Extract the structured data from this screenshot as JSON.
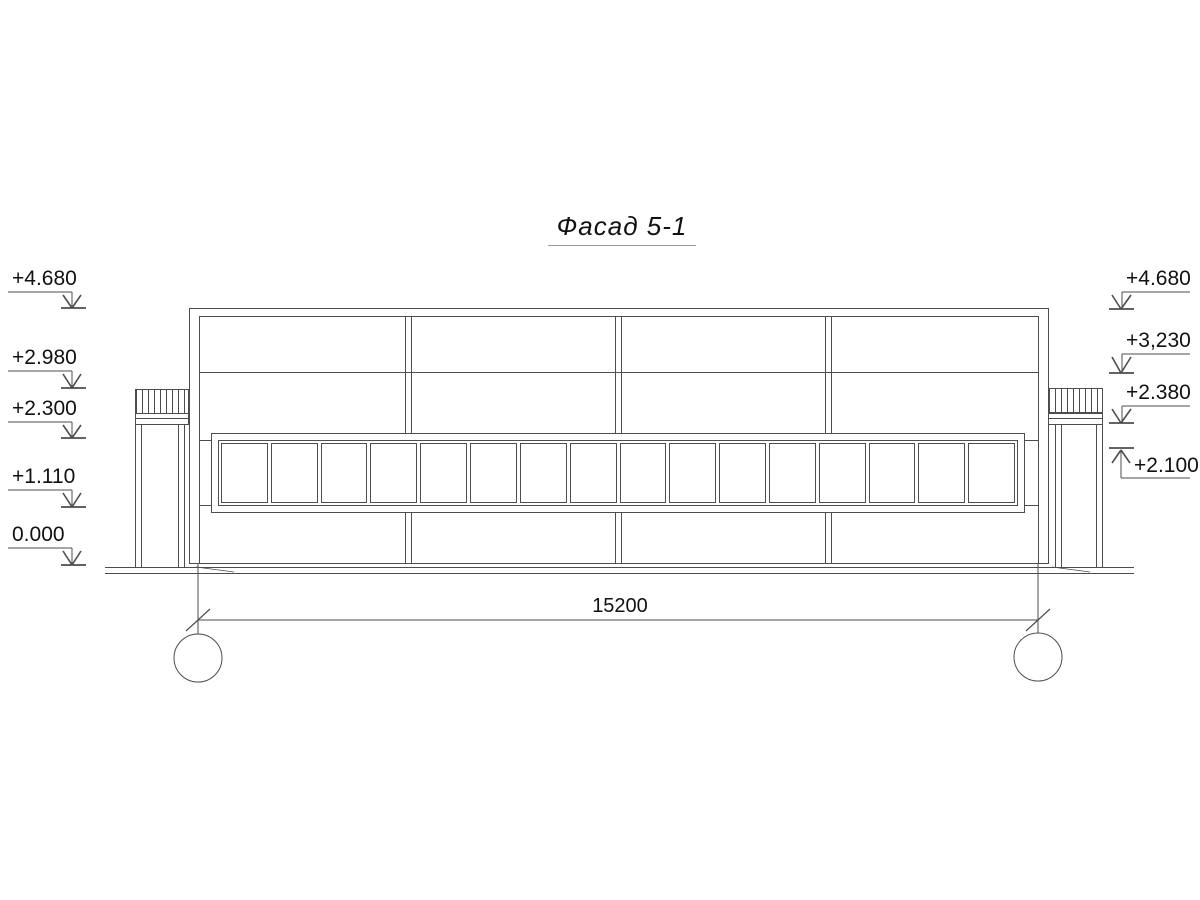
{
  "title": "Фасад 5-1",
  "elevation_marks": {
    "left": [
      {
        "label": "+4.680",
        "leader_y": 292,
        "bar_y": 308
      },
      {
        "label": "+2.980",
        "leader_y": 371,
        "bar_y": 388
      },
      {
        "label": "+2.300",
        "leader_y": 422,
        "bar_y": 438
      },
      {
        "label": "+1.110",
        "leader_y": 490,
        "bar_y": 507
      },
      {
        "label": "0.000",
        "leader_y": 548,
        "bar_y": 565
      }
    ],
    "right": [
      {
        "label": "+4.680",
        "leader_y": 292,
        "bar_y": 309,
        "direction": "down"
      },
      {
        "label": "+3,230",
        "leader_y": 354,
        "bar_y": 373,
        "direction": "down"
      },
      {
        "label": "+2.380",
        "leader_y": 406,
        "bar_y": 423,
        "direction": "down"
      },
      {
        "label": "+2.100",
        "leader_y": 478,
        "bar_y": 448,
        "direction": "up"
      }
    ]
  },
  "dimension": {
    "value": "15200"
  },
  "axes": {
    "left": "5",
    "right": "1"
  },
  "window_band": {
    "pane_count": 16
  },
  "colors": {
    "line": "#4d4d4d",
    "text": "#111111"
  }
}
